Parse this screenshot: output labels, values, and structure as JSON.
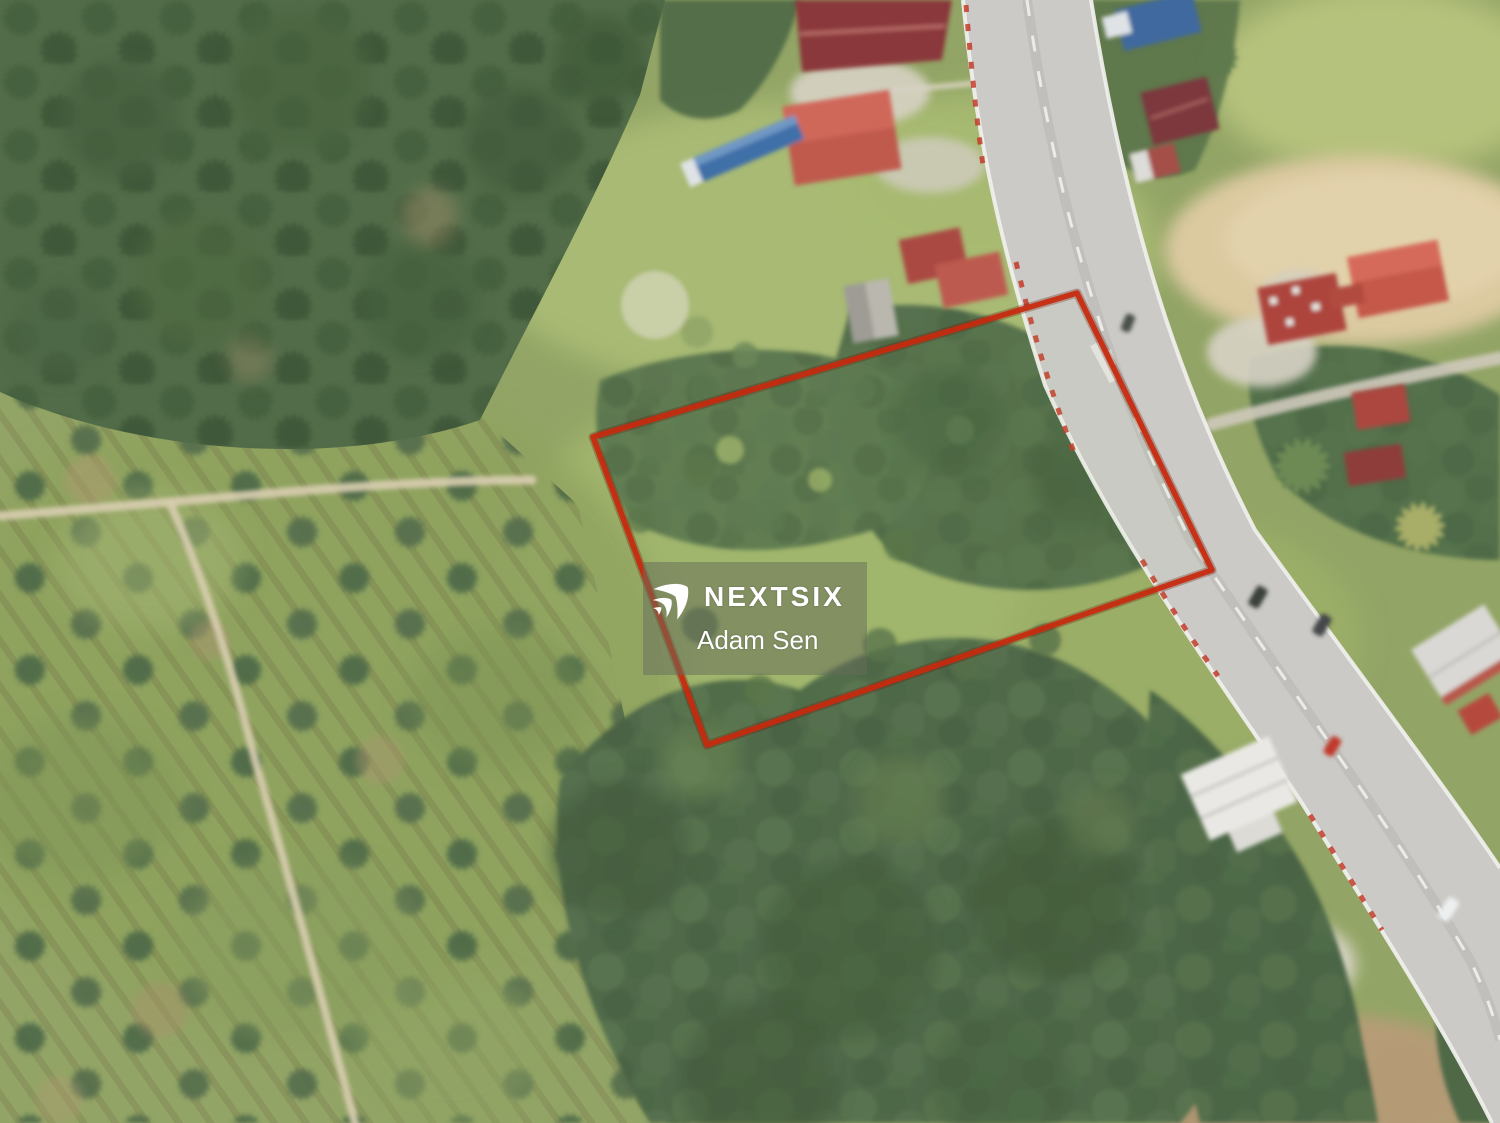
{
  "watermark": {
    "brand": "NEXTSIX",
    "agent": "Adam Sen",
    "logo_icon": "nextsix-swoosh-icon",
    "panel_color": "rgba(104,110,90,0.52)",
    "text_color": "#ffffff"
  },
  "boundary": {
    "points": "1077,293 1212,570 707,745 593,437",
    "color": "#c9290d"
  },
  "scene_colors": {
    "grass_green": "#93a566",
    "forest_green": "#55704c",
    "road_gray": "#cbcac6",
    "sand_tan": "#ddcba2",
    "boundary_red": "#c9290d"
  }
}
